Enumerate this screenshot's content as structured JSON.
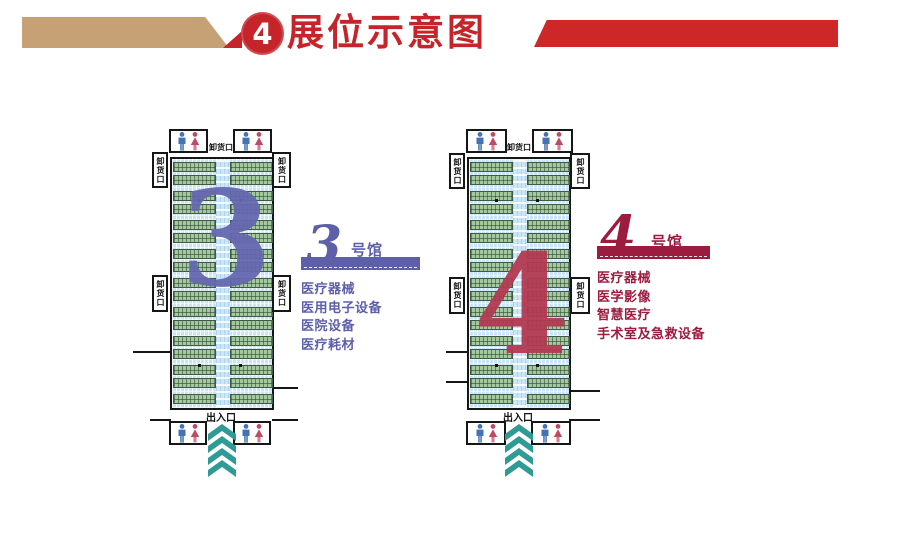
{
  "header": {
    "badge_number": "4",
    "title": "展位示意图"
  },
  "halls": [
    {
      "name": "3号馆",
      "big_number": "3",
      "label_number": "3",
      "label_suffix": "号馆",
      "dock_label": "卸货口",
      "entrance_label": "出入口",
      "categories": [
        "医疗器械",
        "医用电子设备",
        "医院设备",
        "医疗耗材"
      ],
      "booth_rows": 17,
      "accent_color": "#5d5fa9",
      "big_number_color": "#6568b0"
    },
    {
      "name": "4号馆",
      "big_number": "4",
      "label_number": "4",
      "label_suffix": "号馆",
      "dock_label": "卸货口",
      "entrance_label": "出入口",
      "categories": [
        "医疗器械",
        "医学影像",
        "智慧医疗",
        "手术室及急救设备"
      ],
      "booth_rows": 17,
      "accent_color": "#9c1c3f",
      "big_number_color": "#b23a52"
    }
  ],
  "icons": {
    "badge": "number-badge",
    "restroom_male": "male-restroom-icon",
    "restroom_female": "female-restroom-icon",
    "entrance_arrows": "chevron-up-arrows-icon"
  },
  "palette": {
    "header_red": "#c5242b",
    "banner_tan": "#c7a176",
    "banner_red": "#ce2727",
    "booth_green": "#a4c89e",
    "aisle_blue": "#cbe6f6",
    "chevron_teal": "#2e9b94",
    "male_icon_blue": "#4472b6",
    "female_icon_red": "#c04a66"
  }
}
